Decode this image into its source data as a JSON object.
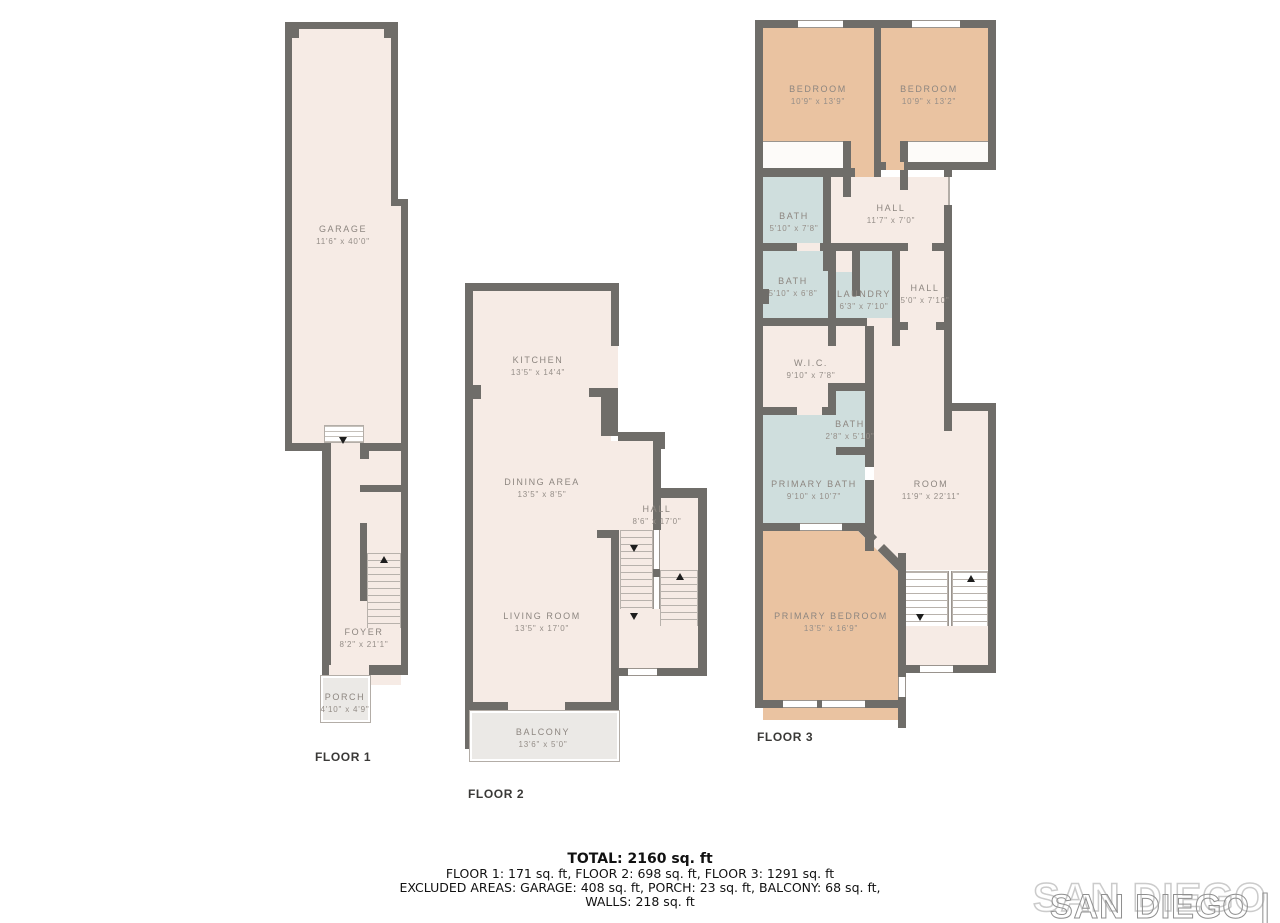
{
  "floors": [
    {
      "label": "FLOOR 1",
      "rooms": [
        {
          "name": "GARAGE",
          "dims": "11'6\" x 40'0\""
        },
        {
          "name": "FOYER",
          "dims": "8'2\" x 21'1\""
        },
        {
          "name": "PORCH",
          "dims": "4'10\" x 4'9\""
        }
      ]
    },
    {
      "label": "FLOOR 2",
      "rooms": [
        {
          "name": "KITCHEN",
          "dims": "13'5\" x 14'4\""
        },
        {
          "name": "DINING AREA",
          "dims": "13'5\" x 8'5\""
        },
        {
          "name": "HALL",
          "dims": "8'6\" x 17'0\""
        },
        {
          "name": "LIVING ROOM",
          "dims": "13'5\" x 17'0\""
        },
        {
          "name": "BALCONY",
          "dims": "13'6\" x 5'0\""
        }
      ]
    },
    {
      "label": "FLOOR 3",
      "rooms": [
        {
          "name": "BEDROOM",
          "dims": "10'9\" x 13'9\""
        },
        {
          "name": "BEDROOM",
          "dims": "10'9\" x 13'2\""
        },
        {
          "name": "BATH",
          "dims": "5'10\" x 7'8\""
        },
        {
          "name": "HALL",
          "dims": "11'7\" x 7'0\""
        },
        {
          "name": "BATH",
          "dims": "5'10\" x 6'8\""
        },
        {
          "name": "LAUNDRY",
          "dims": "6'3\" x 7'10\""
        },
        {
          "name": "HALL",
          "dims": "5'0\" x 7'10\""
        },
        {
          "name": "W.I.C.",
          "dims": "9'10\" x 7'8\""
        },
        {
          "name": "BATH",
          "dims": "2'8\" x 5'10\""
        },
        {
          "name": "PRIMARY BATH",
          "dims": "9'10\" x 10'7\""
        },
        {
          "name": "ROOM",
          "dims": "11'9\" x 22'11\""
        },
        {
          "name": "PRIMARY BEDROOM",
          "dims": "13'5\" x 16'9\""
        }
      ]
    }
  ],
  "summary": {
    "total": "TOTAL: 2160 sq. ft",
    "floors_line": "FLOOR 1: 171 sq. ft, FLOOR 2: 698 sq. ft, FLOOR 3: 1291 sq. ft",
    "excluded_line": "EXCLUDED AREAS: GARAGE: 408 sq. ft, PORCH: 23 sq. ft, BALCONY: 68 sq. ft,",
    "walls_line": "WALLS: 218 sq. ft"
  },
  "watermark": "SAN DIEGO | MLS",
  "colors": {
    "wall": "#6f6d69",
    "floor": "#f6ebe5",
    "bedroom": "#eac3a1",
    "bath": "#cfdedd",
    "outdoor": "#ebe9e6"
  }
}
